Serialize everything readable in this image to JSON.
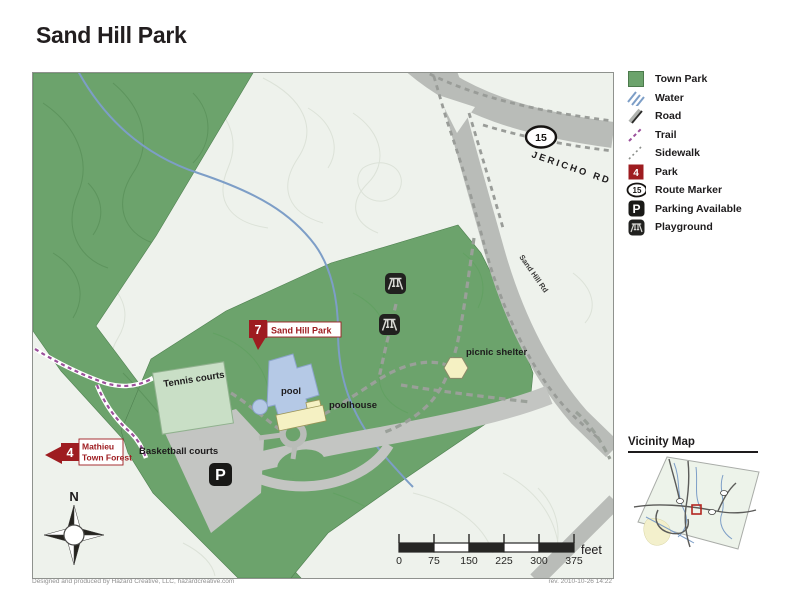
{
  "page": {
    "title": "Sand Hill Park",
    "credit": "Designed and produced by Hazard Creative, LLC, hazardcreative.com",
    "revision": "rev. 2010-10-26 14:22"
  },
  "legend": {
    "items": [
      {
        "icon": "town-park-swatch",
        "label": "Town Park"
      },
      {
        "icon": "water-lines",
        "label": "Water"
      },
      {
        "icon": "road-line",
        "label": "Road"
      },
      {
        "icon": "trail-dashes",
        "label": "Trail"
      },
      {
        "icon": "sidewalk-dots",
        "label": "Sidewalk"
      },
      {
        "icon": "park-marker",
        "label": "Park",
        "value": "4"
      },
      {
        "icon": "route-oval",
        "label": "Route Marker",
        "value": "15"
      },
      {
        "icon": "parking-square",
        "label": "Parking Available",
        "value": "P"
      },
      {
        "icon": "playground-square",
        "label": "Playground"
      }
    ]
  },
  "map": {
    "labels": {
      "jericho_rd": "JERICHO RD",
      "sand_hill_rd": "Sand Hill Rd",
      "route_marker": "15",
      "tennis_courts": "Tennis courts",
      "pool": "pool",
      "poolhouse": "poolhouse",
      "basketball_courts": "Basketball courts",
      "picnic_shelter": "picnic shelter",
      "parking": "P",
      "north": "N"
    },
    "markers": {
      "park7": {
        "number": "7",
        "label": "Sand Hill Park"
      },
      "park4": {
        "number": "4",
        "label_line1": "Mathieu",
        "label_line2": "Town Forest"
      }
    },
    "scale_bar": {
      "ticks": [
        "0",
        "75",
        "150",
        "225",
        "300",
        "375"
      ],
      "unit": "feet"
    }
  },
  "vicinity": {
    "title": "Vicinity Map"
  },
  "colors": {
    "park_green": "#6ca36c",
    "light_green_court": "#c9dfc6",
    "map_background": "#eef2ec",
    "road_gray": "#b9bcb8",
    "parking_gray": "#c3c5c2",
    "water_blue": "#7d9ec7",
    "pool_blue": "#b5c9e6",
    "building_yellow": "#f5f1c3",
    "marker_red": "#9e1c20",
    "trail_purple": "#9b4f9b",
    "text_black": "#1d1b1c"
  }
}
